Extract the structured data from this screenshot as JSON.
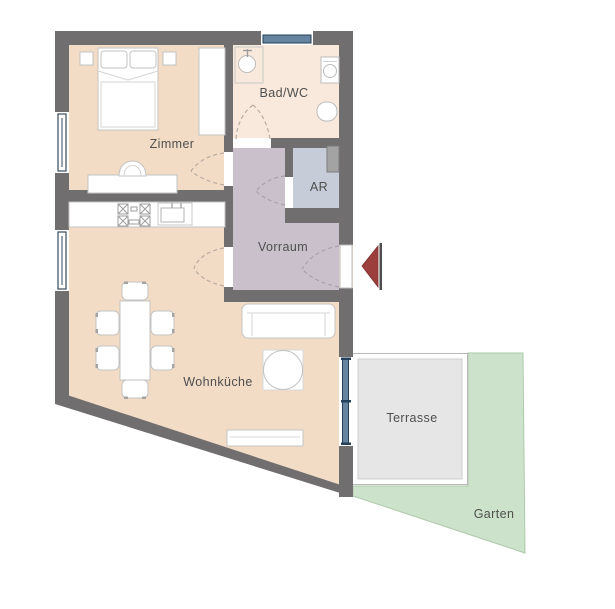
{
  "floorplan": {
    "rooms": {
      "zimmer": "Zimmer",
      "bad_wc": "Bad/WC",
      "ar": "AR",
      "vorraum": "Vorraum",
      "wohnkueche": "Wohnküche",
      "terrasse": "Terrasse",
      "garten": "Garten"
    },
    "colors": {
      "wall": "#706e6f",
      "room_floor": "#f2dcc6",
      "bath_floor": "#f8e9dc",
      "vorraum_floor": "#c9c0cb",
      "ar_floor": "#c6cdd9",
      "garden": "#cde2ca",
      "terrace": "#e6e6e6",
      "glass": "#66839f",
      "glass_frame": "#24405a",
      "entrance_arrow": "#9c3e3c",
      "label_text": "#4f4f4f"
    },
    "icons": {
      "entrance_arrow": "entrance-direction-arrow"
    },
    "furniture": [
      "double-bed",
      "nightstand",
      "wardrobe",
      "desk",
      "desk-chair",
      "shower-tray",
      "washbasin",
      "washing-machine",
      "toilet",
      "kitchen-counter",
      "stove",
      "kitchen-sink",
      "dining-table",
      "dining-chair",
      "sofa",
      "coffee-table",
      "lowboard",
      "duct-shaft"
    ]
  }
}
